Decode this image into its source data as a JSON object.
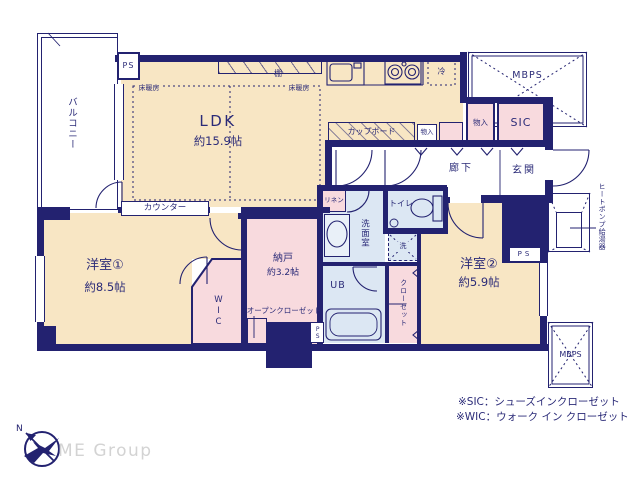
{
  "floorplan": {
    "rooms": {
      "balcony": {
        "label": "バルコニー"
      },
      "ldk": {
        "label": "LDK",
        "size": "約15.9帖"
      },
      "bedroom1": {
        "label": "洋室①",
        "size": "約8.5帖"
      },
      "bedroom2": {
        "label": "洋室②",
        "size": "約5.9帖"
      },
      "storage_room": {
        "label": "納戸",
        "size": "約3.2帖"
      },
      "wic": {
        "label": "WIC"
      },
      "hallway": {
        "label": "廊下"
      },
      "entrance": {
        "label": "玄関"
      },
      "washroom": {
        "label": "洗面室"
      },
      "toilet": {
        "label": "トイレ"
      },
      "unit_bath": {
        "label": "UB"
      },
      "sic": {
        "label": "SIC"
      }
    },
    "fixtures": {
      "counter": "カウンター",
      "cupboard": "カップボード",
      "shelf": "棚",
      "fridge": "冷",
      "floor_heating": "床暖房",
      "linen": "リネン",
      "laundry": "洗",
      "closet": "クローゼット",
      "open_closet": "オープンクローゼット",
      "storage": "物入",
      "heat_pump": "ヒートポンプ給湯器",
      "ps": "PS",
      "mbps": "MBPS"
    },
    "compass": {
      "north": "N"
    },
    "watermark": "ME Group",
    "notes": {
      "sic": "※SIC：シューズインクローゼット",
      "wic": "※WIC：ウォーク イン クローゼット"
    },
    "colors": {
      "wall": "#232270",
      "text": "#2b2b78",
      "room_fill": "#f8e6c4",
      "closet_fill": "#f8dade",
      "wet_fill": "#dce7f3",
      "watermark": "#d3d3d3"
    }
  }
}
